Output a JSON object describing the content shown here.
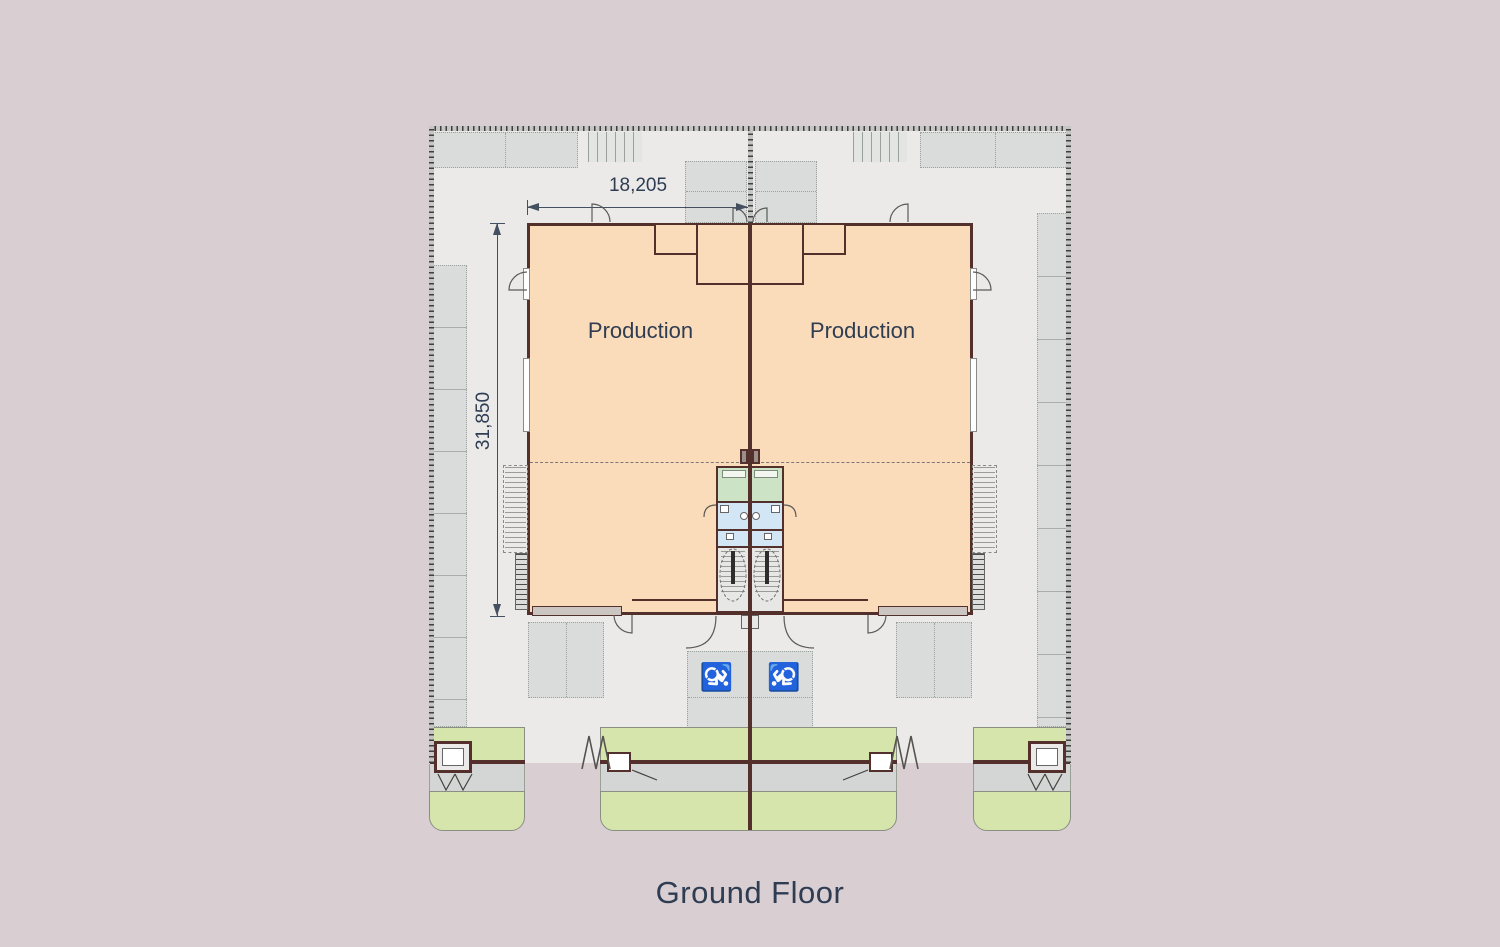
{
  "page": {
    "caption": "Ground Floor"
  },
  "plan": {
    "type": "architectural-floor-plan",
    "dimensions": {
      "width_label": "18,205",
      "height_label": "31,850"
    },
    "rooms": {
      "production_left": "Production",
      "production_right": "Production"
    },
    "icons": {
      "wheelchair_left": "♿",
      "wheelchair_right": "♿"
    },
    "colors": {
      "page_background": "#d9ced2",
      "site_fill": "#ebeae8",
      "building_fill": "#fbdcba",
      "wall": "#54302d",
      "parking_band": "#d9dcda",
      "landscape_green": "#d6e5ab",
      "core_green_room": "#cde3c6",
      "core_blue_room": "#d3e6f5",
      "text": "#2e3d52"
    }
  }
}
